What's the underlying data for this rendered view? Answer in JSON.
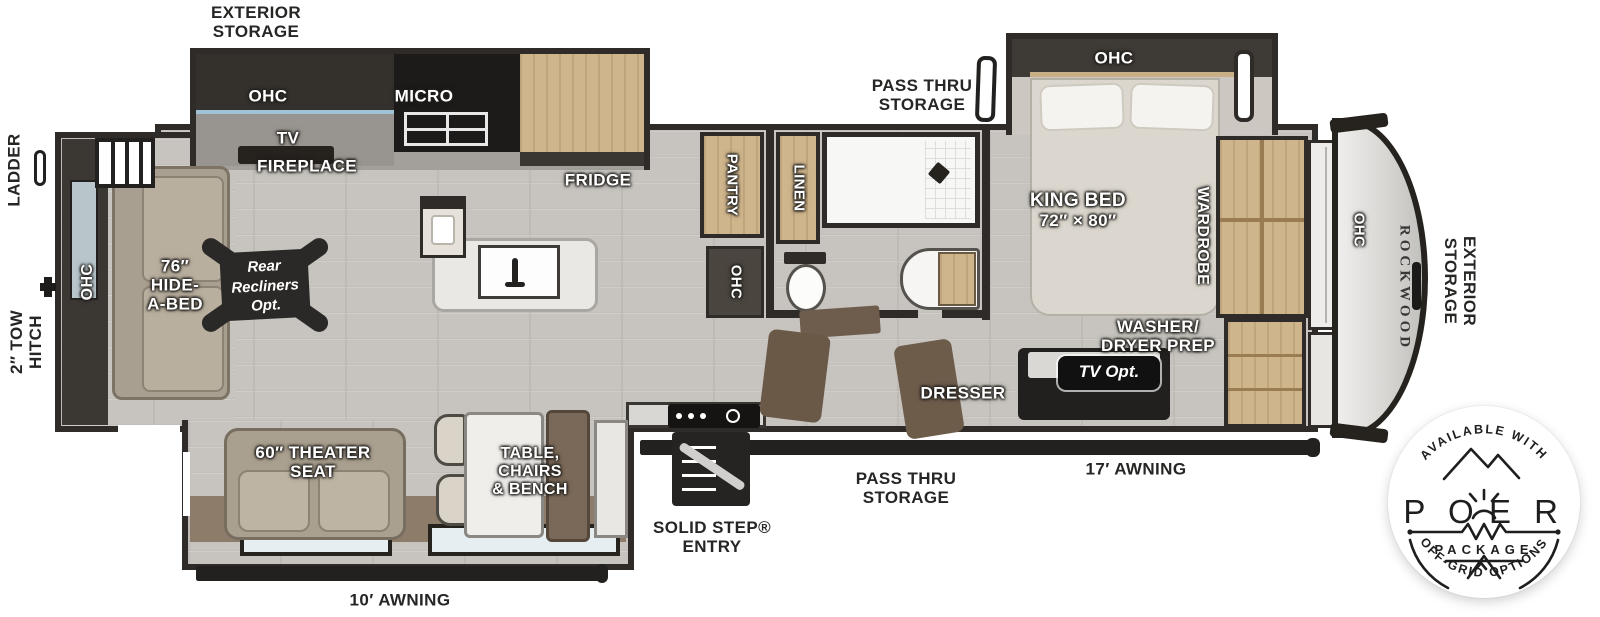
{
  "title": "ROCKWOOD fifth wheel floor plan",
  "brand": "ROCKWOOD",
  "colors": {
    "wall": "#2e2b28",
    "floor": "#c7c4bf",
    "cabinet_wood": "#cfb58c",
    "dark_cabinet": "#34312d",
    "sofa": "#a99f90",
    "led_accent": "#9fc2d6",
    "badge_ink": "#1e1e1e"
  },
  "labels": {
    "exterior_storage_top": {
      "l1": "EXTERIOR",
      "l2": "STORAGE"
    },
    "pass_thru_top": {
      "l1": "PASS THRU",
      "l2": "STORAGE"
    },
    "ladder": "LADDER",
    "tow_hitch": {
      "l1": "2″ TOW",
      "l2": "HITCH"
    },
    "ohc": "OHC",
    "micro": "MICRO",
    "tv": "TV",
    "fireplace": "FIREPLACE",
    "fridge": "FRIDGE",
    "pantry": "PANTRY",
    "linen": "LINEN",
    "king_bed": {
      "l1": "KING BED",
      "l2": "72″ × 80″"
    },
    "wardrobe": "WARDROBE",
    "washer_dryer": {
      "l1": "WASHER/",
      "l2": "DRYER PREP"
    },
    "dresser": "DRESSER",
    "tv_opt": "TV Opt.",
    "hide_a_bed": {
      "l1": "76″",
      "l2": "HIDE-",
      "l3": "A-BED"
    },
    "rear_recliners": {
      "l1": "Rear",
      "l2": "Recliners",
      "l3": "Opt."
    },
    "theater_seat": {
      "l1": "60″ THEATER",
      "l2": "SEAT"
    },
    "dinette": {
      "l1": "TABLE,",
      "l2": "CHAIRS",
      "l3": "& BENCH"
    },
    "solid_step": {
      "l1": "SOLID STEP®",
      "l2": "ENTRY"
    },
    "pass_thru_bottom": {
      "l1": "PASS THRU",
      "l2": "STORAGE"
    },
    "awning_17": "17′ AWNING",
    "awning_10": "10′ AWNING",
    "rockwood": "ROCKWOOD",
    "exterior_storage_right": {
      "l1": "EXTERIOR",
      "l2": "STORAGE"
    }
  },
  "badge": {
    "arc_top": "AVAILABLE WITH",
    "power_left": "P O",
    "power_right": "E R",
    "package": "PACKAGE",
    "arc_bottom": "OFF-GRID OPTIONS"
  }
}
